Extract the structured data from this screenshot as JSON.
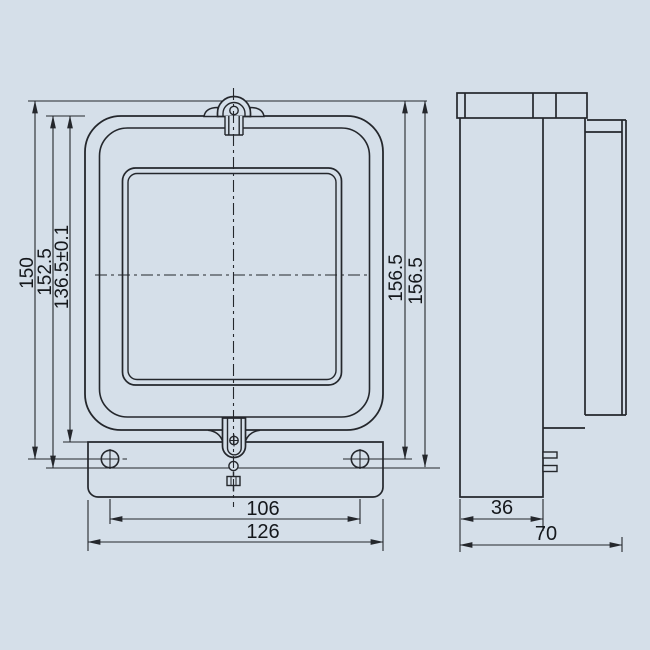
{
  "drawing": {
    "type": "engineering-dimension-drawing",
    "subject": "meter-case-two-views",
    "colors": {
      "background": "#d5dfe9",
      "line": "#24272c",
      "text": "#15181c"
    },
    "views": {
      "front": {
        "features": [
          "hanging-hook",
          "viewing-window",
          "seal-screw",
          "mounting-holes",
          "bottom-flange"
        ]
      },
      "side": {
        "features": [
          "top-cap",
          "cover-profile",
          "base-profile",
          "terminal-tabs"
        ]
      }
    }
  },
  "dims": {
    "front": {
      "d150": "150",
      "d152_5": "152.5",
      "d136_5": "136.5±0.1",
      "d156_5_a": "156.5",
      "d156_5_b": "156.5",
      "d106": "106",
      "d126": "126"
    },
    "side": {
      "d36": "36",
      "d70": "70"
    }
  }
}
